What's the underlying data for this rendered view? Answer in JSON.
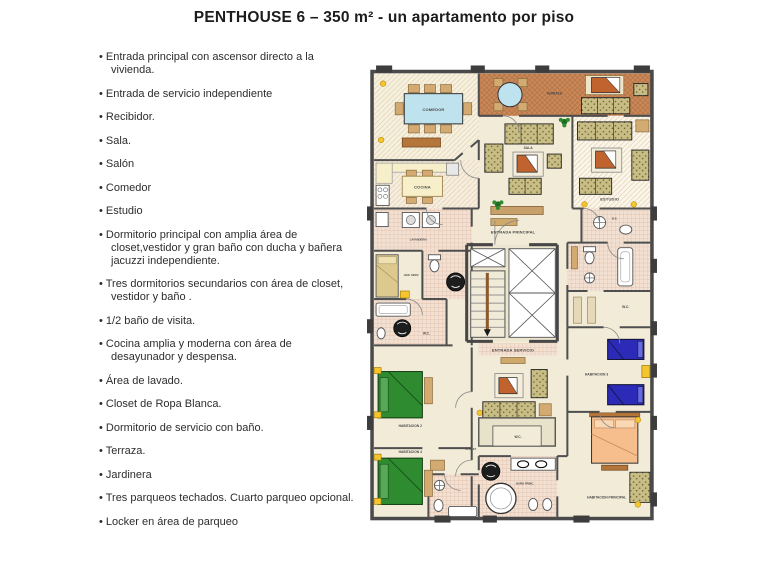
{
  "title": "PENTHOUSE 6 – 350 m² - un apartamento por piso",
  "features": {
    "items": [
      "Entrada principal con ascensor directo a la vivienda.",
      "Entrada de servicio independiente",
      "Recibidor.",
      "Sala.",
      "Salón",
      "Comedor",
      "Estudio",
      "Dormitorio principal con amplia  área de closet,vestidor y gran baño con ducha y bañera jacuzzi independiente.",
      "Tres dormitorios secundarios  con  área de closet, vestidor y baño .",
      "1/2 baño de visita.",
      "Cocina amplia y moderna con área de desayunador y despensa.",
      "Área de lavado.",
      "Closet de Ropa Blanca.",
      "Dormitorio de servicio con baño.",
      "Terraza.",
      "Jardinera",
      "Tres parqueos techados. Cuarto parqueo opcional.",
      "Locker en área de parqueo"
    ]
  },
  "plan": {
    "labels": {
      "comedor": "COMEDOR",
      "terraza": "TERRAZA",
      "sala": "SALA",
      "estudio": "ESTUDIO",
      "cocina": "COCINA",
      "lavanderia": "LAVANDERIA",
      "hab_serv": "HAB. SERV.",
      "wc_serv": "W.C.",
      "bs": "B.S.",
      "wc_right": "W.C.",
      "entrada_principal": "ENTRADA PRINCIPAL",
      "entrada_servicio": "ENTRADA SERVICIO",
      "habitacion2": "HABITACION 2",
      "habitacion3": "HABITACION 3",
      "habitacion4": "HABITACION 4",
      "habitacion_principal": "HABITACION PRINCIPAL",
      "bano_princ": "BAÑO PRINC.",
      "wc_center": "W.C.",
      "closet": "CLOSET"
    },
    "colors": {
      "walls": "#4f4f4f",
      "floor_cream": "#f1ebd7",
      "terrace_brown": "#c9895c",
      "bed_green": "#2e8b30",
      "bed_blue": "#2b2bb8",
      "bed_peach": "#f6bd8d",
      "bed_service_tan": "#ddc98e",
      "sofa_olive": "#c8bd84",
      "table_blue": "#bfe3ee",
      "tv_orange": "#c0632f",
      "lamp_yellow": "#f4c52f",
      "bath_tile": "#f2e0d2"
    }
  }
}
